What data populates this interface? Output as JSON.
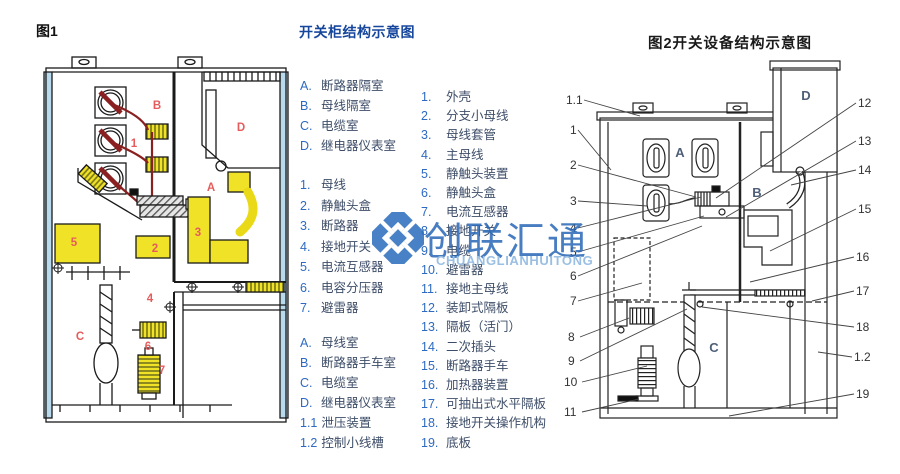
{
  "figure1": {
    "caption": "图1",
    "labels": [
      "B",
      "1",
      "D",
      "A",
      "3",
      "5",
      "2",
      "4",
      "C",
      "6",
      "7"
    ]
  },
  "legend1": {
    "title": "开关柜结构示意图",
    "compartments": [
      {
        "id": "A.",
        "label": "断路器隔室"
      },
      {
        "id": "B.",
        "label": "母线隔室"
      },
      {
        "id": "C.",
        "label": "电缆室"
      },
      {
        "id": "D.",
        "label": "继电器仪表室"
      }
    ],
    "parts": [
      {
        "id": "1.",
        "label": "母线"
      },
      {
        "id": "2.",
        "label": "静触头盒"
      },
      {
        "id": "3.",
        "label": "断路器"
      },
      {
        "id": "4.",
        "label": "接地开关"
      },
      {
        "id": "5.",
        "label": "电流互感器"
      },
      {
        "id": "6.",
        "label": "电容分压器"
      },
      {
        "id": "7.",
        "label": "避雷器"
      }
    ],
    "compartments2": [
      {
        "id": "A.",
        "label": "母线室"
      },
      {
        "id": "B.",
        "label": "断路器手车室"
      },
      {
        "id": "C.",
        "label": "电缆室"
      },
      {
        "id": "D.",
        "label": "继电器仪表室"
      },
      {
        "id": "1.1",
        "label": "泄压装置"
      },
      {
        "id": "1.2",
        "label": "控制小线槽"
      }
    ]
  },
  "legend2": {
    "parts": [
      {
        "id": "1.",
        "label": "外壳"
      },
      {
        "id": "2.",
        "label": "分支小母线"
      },
      {
        "id": "3.",
        "label": "母线套管"
      },
      {
        "id": "4.",
        "label": "主母线"
      },
      {
        "id": "5.",
        "label": "静触头装置"
      },
      {
        "id": "6.",
        "label": "静触头盒"
      },
      {
        "id": "7.",
        "label": "电流互感器"
      },
      {
        "id": "8.",
        "label": "接地开关"
      },
      {
        "id": "9.",
        "label": "电缆"
      },
      {
        "id": "10.",
        "label": "避雷器"
      },
      {
        "id": "11.",
        "label": "接地主母线"
      },
      {
        "id": "12.",
        "label": "装卸式隔板"
      },
      {
        "id": "13.",
        "label": "隔板（活门）"
      },
      {
        "id": "14.",
        "label": "二次插头"
      },
      {
        "id": "15.",
        "label": "断路器手车"
      },
      {
        "id": "16.",
        "label": "加热器装置"
      },
      {
        "id": "17.",
        "label": "可抽出式水平隔板"
      },
      {
        "id": "18.",
        "label": "接地开关操作机构"
      },
      {
        "id": "19.",
        "label": "底板"
      }
    ]
  },
  "figure2": {
    "caption": "图2开关设备结构示意图",
    "letters": [
      "A",
      "B",
      "C",
      "D"
    ],
    "callouts_left": [
      "1.1",
      "1",
      "2",
      "3",
      "4",
      "5",
      "6",
      "7",
      "8",
      "9",
      "10",
      "11"
    ],
    "callouts_right": [
      "12",
      "13",
      "14",
      "15",
      "16",
      "17",
      "18",
      "1.2",
      "19"
    ]
  },
  "watermark": {
    "cn": "创联汇通",
    "en": "CHUANGLIANHUITONG"
  },
  "colors": {
    "title_blue": "#17479d",
    "list_prefix_blue": "#2e6ac1",
    "list_text": "#3d4d68",
    "label_red": "#e65c5c",
    "part_yellow": "#f0e227",
    "cable_red": "#8a2020",
    "panel_blue": "#b9d9ec",
    "watermark_blue": "#2e6cb8",
    "watermark_light_blue": "#8cb6e0"
  }
}
